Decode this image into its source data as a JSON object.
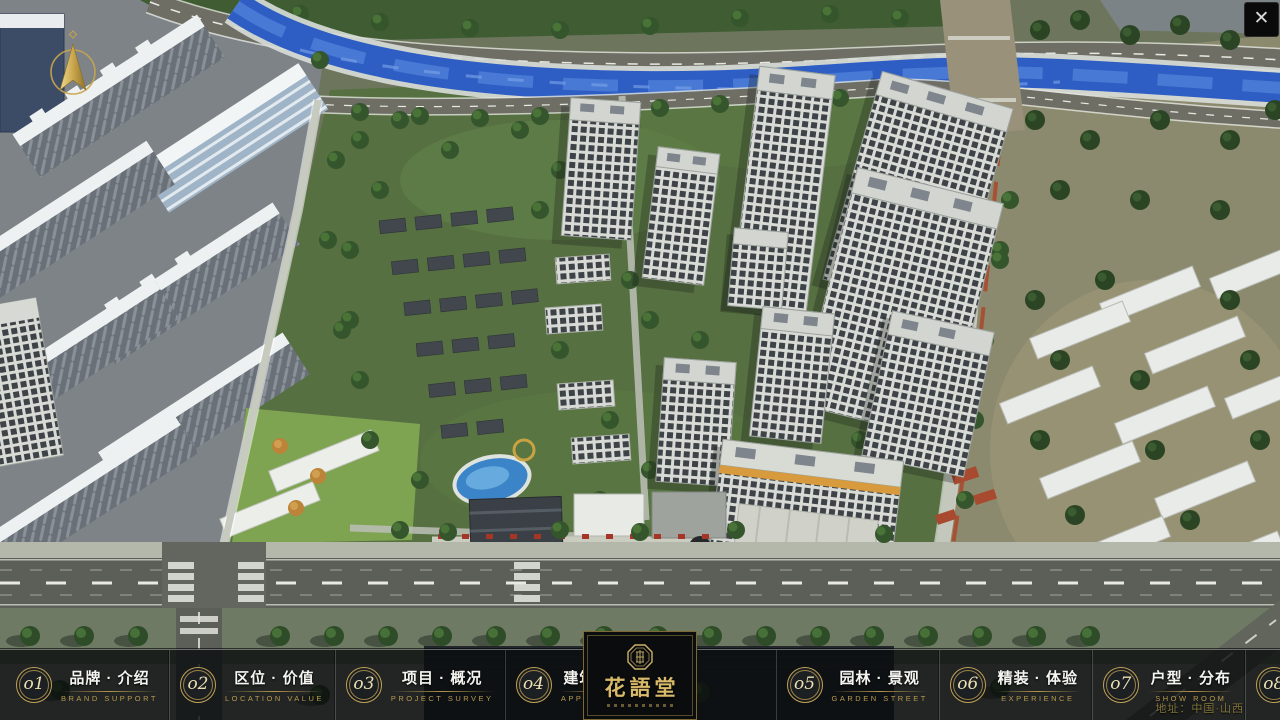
{
  "window": {
    "close": "✕"
  },
  "icons": {
    "close": "x-close",
    "compass": "compass-north-arrow",
    "logo_seal": "octagonal-seal-emblem"
  },
  "nav": {
    "items": [
      {
        "num": "o1",
        "label": "品牌 · 介绍",
        "sub": "BRAND SUPPORT"
      },
      {
        "num": "o2",
        "label": "区位 · 价值",
        "sub": "LOCATION VALUE"
      },
      {
        "num": "o3",
        "label": "项目 · 概况",
        "sub": "PROJECT SURVEY"
      },
      {
        "num": "o4",
        "label": "建筑 · 鉴赏",
        "sub": "APPRECIATION"
      },
      {
        "num": "o5",
        "label": "园林 · 景观",
        "sub": "GARDEN STREET"
      },
      {
        "num": "o6",
        "label": "精装 · 体验",
        "sub": "EXPERIENCE"
      },
      {
        "num": "o7",
        "label": "户型 · 分布",
        "sub": "SHOW ROOM"
      },
      {
        "num": "o8",
        "label": "一房 · 一景",
        "sub": "COMMUNITY"
      }
    ],
    "logo": {
      "title": "花語堂"
    }
  },
  "footer": {
    "address": "地址：中国·山西"
  },
  "colors": {
    "gold": "#b99a4f",
    "gold_bright": "#d9ba6b",
    "nav_bg": "rgba(10,12,14,0.82)",
    "river": "#2e5ec4",
    "accent_red": "#a63427"
  }
}
